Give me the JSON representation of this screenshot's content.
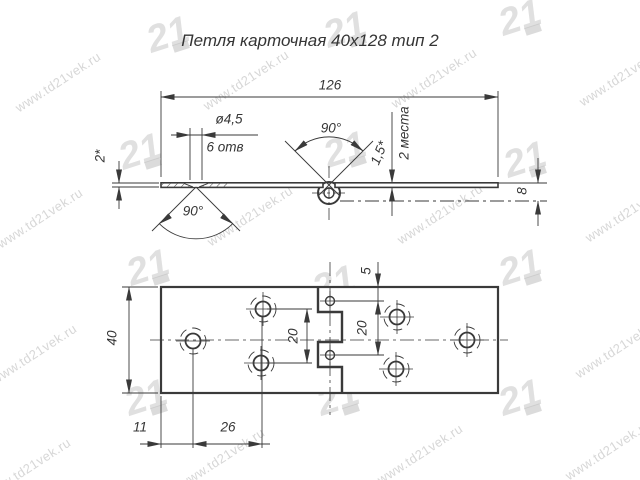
{
  "title": "Петля карточная 40х128 тип 2",
  "watermark": {
    "text": "www.td21vek.ru",
    "logo": "21"
  },
  "side_view": {
    "dims": {
      "length": "126",
      "hole_dia": "ø4,5",
      "hole_count": "6 отв",
      "knuckle_angle": "90°",
      "offset": "1,5*",
      "places": "2 места",
      "thickness": "2*",
      "countersink_angle": "90°",
      "axis_offset": "8"
    }
  },
  "plan_view": {
    "dims": {
      "width": "40",
      "pin_hole_edge": "5",
      "pin_hole_spacing": "20",
      "hole_spacing": "20",
      "edge_to_hole": "11",
      "hole_col_spacing": "26"
    }
  }
}
